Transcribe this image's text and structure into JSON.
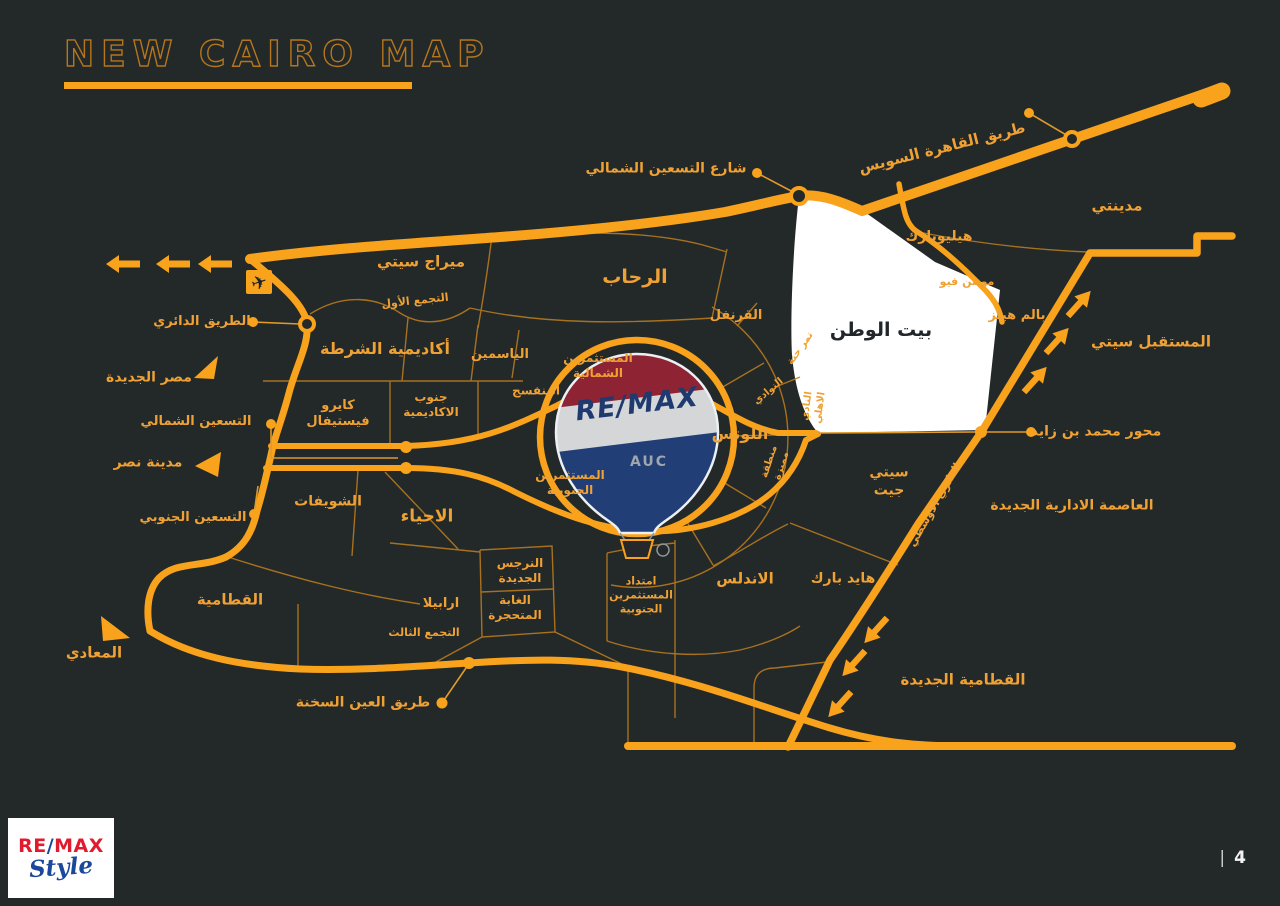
{
  "title": "NEW CAIRO MAP",
  "page": {
    "separator": "|",
    "number": "4"
  },
  "logo": {
    "re": "RE",
    "slash": "/",
    "max": "MAX",
    "style_word": "Style"
  },
  "balloon": {
    "brand": "RE/MAX",
    "campus": "AUC"
  },
  "colors": {
    "background": "#232829",
    "accent_orange": "#F9A21B",
    "boundary_orange": "#BA7C1E",
    "label_orange": "#EFA133",
    "white_region": "#FFFFFF",
    "balloon_red": "#8E2433",
    "balloon_navy": "#223E76",
    "logo_red": "#E11B2E",
    "logo_blue": "#1B489B"
  },
  "labels": {
    "mirage_city": "ميراج سيتي",
    "first_settlement": "التجمع الأول",
    "rehab": "الرحاب",
    "qoronfol": "القرنفل",
    "police_academy": "أكاديمية الشرطة",
    "yasmin": "الياسمين",
    "investors_north": "المستثمرين الشمالية",
    "banafseg": "البنفسج",
    "cairo_festival": "كايرو فيستيفال",
    "south_academy": "جنوب الاكاديمية",
    "lotus": "اللوتس",
    "beit_el_watan": "بيت الوطن",
    "heliopark": "هيليوبارك",
    "madinaty": "مدينتي",
    "mountain_view": "مونتن فيو",
    "palm_hills": "بالم هيلز",
    "mostakbal_city": "المستقبل سيتي",
    "city_gate": "سيتي جيت",
    "new_capital": "العاصمة الادارية الجديدة",
    "shouyfat": "الشويفات",
    "ahyaa": "الاحياء",
    "investors_south": "المستثمرين الجنوبية",
    "andalus": "الاندلس",
    "hyde_park": "هايد بارك",
    "new_narges": "النرجس الجديدة",
    "petrified_forest": "الغابة المتحجرة",
    "investors_south_ext": "امتداد المستثمرين الجنوبية",
    "arabella": "ارابيلا",
    "third_settlement": "التجمع الثالث",
    "katameya": "القطامية",
    "new_katameya": "القطامية الجديدة",
    "heliopolis": "مصر الجديدة",
    "nasr_city": "مدينة نصر",
    "maadi": "المعادي",
    "north90_street": "شارع التسعين الشمالي",
    "cairo_suez_road": "طريق القاهرة السويس",
    "ring_road": "الطريق الدائري",
    "north90": "التسعين الشمالي",
    "south90": "التسعين الجنوبي",
    "sokhna_road": "طريق العين السخنة",
    "mbz_axis": "محور محمد بن زايد",
    "middle_ring_road": "الدائري الاوسطي",
    "tamr_henna": "تمر حنة",
    "ahly_club": "النادي الاهلي",
    "nawadi": "النوادي",
    "montaqa": "منطقة مميزة"
  }
}
